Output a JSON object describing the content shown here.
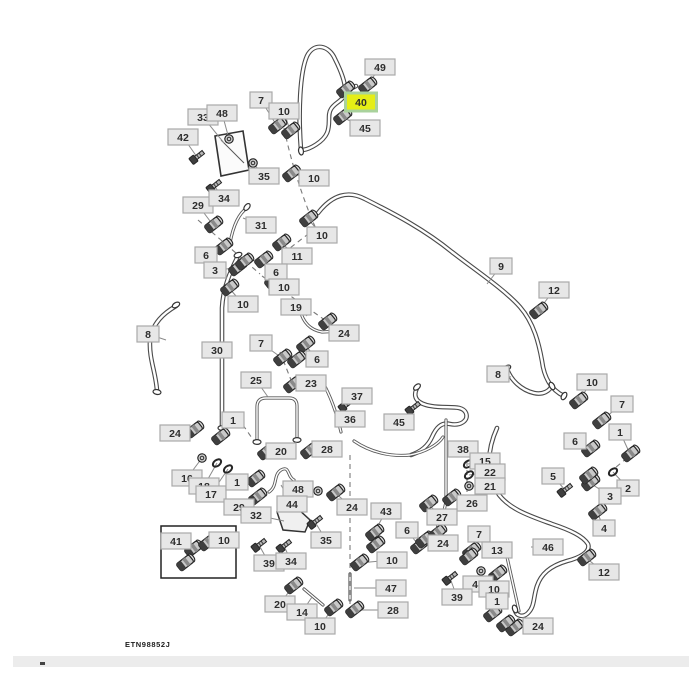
{
  "figure_code": "ETN98852J",
  "diagram": {
    "canvas": {
      "w": 700,
      "h": 700,
      "bg": "#ffffff"
    },
    "styles": {
      "label_fill": "#e7e7e7",
      "label_border": "#a9a9a9",
      "label_text": "#2e2e2e",
      "highlight_fill": "#e5ee16",
      "highlight_border": "#a9d29c",
      "hose_outer": "#4a4a4a",
      "hose_inner": "#ffffff",
      "tube_outer": "#5a5a5a",
      "tube_inner": "#ffffff",
      "dash_color": "#7a7a7a",
      "leader_color": "#8a8a8a",
      "part_dark": "#3f3f3f",
      "part_mid": "#8a8a8a",
      "part_light": "#c9c9c9",
      "part_stroke": "#262626"
    },
    "callouts": [
      {
        "n": "49",
        "x": 380,
        "y": 67,
        "tx": 367,
        "ty": 86,
        "k": "f"
      },
      {
        "n": "40",
        "x": 361,
        "y": 102,
        "tx": 345,
        "ty": 90,
        "k": "f",
        "hl": true
      },
      {
        "n": "45",
        "x": 365,
        "y": 128,
        "tx": 342,
        "ty": 117,
        "k": "f"
      },
      {
        "n": "7",
        "x": 261,
        "y": 100,
        "tx": 277,
        "ty": 126,
        "k": "f"
      },
      {
        "n": "10",
        "x": 284,
        "y": 111,
        "tx": 290,
        "ty": 131,
        "k": "f"
      },
      {
        "n": "33",
        "x": 203,
        "y": 117,
        "tx": 224,
        "ty": 143,
        "k": "none"
      },
      {
        "n": "48",
        "x": 222,
        "y": 113,
        "tx": 229,
        "ty": 139,
        "k": "n"
      },
      {
        "n": "42",
        "x": 183,
        "y": 137,
        "tx": 197,
        "ty": 157,
        "k": "b"
      },
      {
        "n": "35",
        "x": 264,
        "y": 176,
        "tx": 253,
        "ty": 163,
        "k": "n"
      },
      {
        "n": "10",
        "x": 314,
        "y": 178,
        "tx": 291,
        "ty": 174,
        "k": "f"
      },
      {
        "n": "29",
        "x": 198,
        "y": 205,
        "tx": 213,
        "ty": 225,
        "k": "f"
      },
      {
        "n": "34",
        "x": 224,
        "y": 198,
        "tx": 214,
        "ty": 186,
        "k": "b"
      },
      {
        "n": "31",
        "x": 261,
        "y": 225,
        "tx": 243,
        "ty": 218,
        "k": "none"
      },
      {
        "n": "10",
        "x": 322,
        "y": 235,
        "tx": 308,
        "ty": 219,
        "k": "f"
      },
      {
        "n": "11",
        "x": 297,
        "y": 256,
        "tx": 281,
        "ty": 243,
        "k": "f"
      },
      {
        "n": "6",
        "x": 206,
        "y": 255,
        "tx": 223,
        "ty": 247,
        "k": "f"
      },
      {
        "n": "3",
        "x": 215,
        "y": 270,
        "tx": 237,
        "ty": 268,
        "k": "f"
      },
      {
        "n": "6",
        "x": 276,
        "y": 272,
        "tx": 263,
        "ty": 260,
        "k": "f"
      },
      {
        "n": "10",
        "x": 284,
        "y": 287,
        "tx": 273,
        "ty": 281,
        "k": "f"
      },
      {
        "n": "10",
        "x": 243,
        "y": 304,
        "tx": 229,
        "ty": 288,
        "k": "f"
      },
      {
        "n": "19",
        "x": 296,
        "y": 307,
        "tx": 307,
        "ty": 316,
        "k": "none"
      },
      {
        "n": "24",
        "x": 344,
        "y": 333,
        "tx": 327,
        "ty": 322,
        "k": "f"
      },
      {
        "n": "8",
        "x": 148,
        "y": 334,
        "tx": 166,
        "ty": 340,
        "k": "none"
      },
      {
        "n": "30",
        "x": 217,
        "y": 350,
        "tx": 227,
        "ty": 347,
        "k": "none"
      },
      {
        "n": "7",
        "x": 261,
        "y": 343,
        "tx": 282,
        "ty": 358,
        "k": "f"
      },
      {
        "n": "6",
        "x": 317,
        "y": 359,
        "tx": 305,
        "ty": 345,
        "k": "f"
      },
      {
        "n": "25",
        "x": 256,
        "y": 380,
        "tx": 268,
        "ty": 397,
        "k": "none"
      },
      {
        "n": "23",
        "x": 311,
        "y": 383,
        "tx": 292,
        "ty": 385,
        "k": "f"
      },
      {
        "n": "37",
        "x": 357,
        "y": 396,
        "tx": 346,
        "ty": 405,
        "k": "b"
      },
      {
        "n": "36",
        "x": 350,
        "y": 419,
        "tx": 340,
        "ty": 421,
        "k": "none"
      },
      {
        "n": "45",
        "x": 399,
        "y": 422,
        "tx": 413,
        "ty": 408,
        "k": "b"
      },
      {
        "n": "9",
        "x": 501,
        "y": 266,
        "tx": 487,
        "ty": 284,
        "k": "none"
      },
      {
        "n": "12",
        "x": 554,
        "y": 290,
        "tx": 538,
        "ty": 311,
        "k": "f"
      },
      {
        "n": "8",
        "x": 498,
        "y": 374,
        "tx": 511,
        "ty": 377,
        "k": "none"
      },
      {
        "n": "10",
        "x": 592,
        "y": 382,
        "tx": 578,
        "ty": 401,
        "k": "f"
      },
      {
        "n": "7",
        "x": 622,
        "y": 404,
        "tx": 601,
        "ty": 421,
        "k": "f"
      },
      {
        "n": "1",
        "x": 620,
        "y": 432,
        "tx": 630,
        "ty": 454,
        "k": "f"
      },
      {
        "n": "6",
        "x": 575,
        "y": 441,
        "tx": 590,
        "ty": 449,
        "k": "f"
      },
      {
        "n": "5",
        "x": 553,
        "y": 476,
        "tx": 565,
        "ty": 490,
        "k": "b"
      },
      {
        "n": "2",
        "x": 628,
        "y": 488,
        "tx": 613,
        "ty": 472,
        "k": "r"
      },
      {
        "n": "3",
        "x": 610,
        "y": 496,
        "tx": 590,
        "ty": 483,
        "k": "f"
      },
      {
        "n": "4",
        "x": 604,
        "y": 528,
        "tx": 597,
        "ty": 512,
        "k": "f"
      },
      {
        "n": "12",
        "x": 604,
        "y": 572,
        "tx": 586,
        "ty": 558,
        "k": "f"
      },
      {
        "n": "46",
        "x": 548,
        "y": 547,
        "tx": 531,
        "ty": 547,
        "k": "none"
      },
      {
        "n": "38",
        "x": 463,
        "y": 449,
        "tx": 448,
        "ty": 450,
        "k": "none"
      },
      {
        "n": "15",
        "x": 485,
        "y": 461,
        "tx": 468,
        "ty": 464,
        "k": "r"
      },
      {
        "n": "22",
        "x": 490,
        "y": 472,
        "tx": 469,
        "ty": 475,
        "k": "r"
      },
      {
        "n": "21",
        "x": 490,
        "y": 486,
        "tx": 469,
        "ty": 486,
        "k": "n"
      },
      {
        "n": "26",
        "x": 472,
        "y": 503,
        "tx": 451,
        "ty": 498,
        "k": "f"
      },
      {
        "n": "27",
        "x": 442,
        "y": 517,
        "tx": 428,
        "ty": 504,
        "k": "f"
      },
      {
        "n": "24",
        "x": 352,
        "y": 507,
        "tx": 335,
        "ty": 493,
        "k": "f"
      },
      {
        "n": "43",
        "x": 386,
        "y": 511,
        "tx": 374,
        "ty": 533,
        "k": "f"
      },
      {
        "n": "6",
        "x": 407,
        "y": 530,
        "tx": 419,
        "ty": 546,
        "k": "f"
      },
      {
        "n": "24",
        "x": 443,
        "y": 543,
        "tx": 424,
        "ty": 540,
        "k": "f"
      },
      {
        "n": "10",
        "x": 392,
        "y": 560,
        "tx": 359,
        "ty": 563,
        "k": "f"
      },
      {
        "n": "47",
        "x": 391,
        "y": 588,
        "tx": 354,
        "ty": 588,
        "k": "none"
      },
      {
        "n": "28",
        "x": 393,
        "y": 610,
        "tx": 354,
        "ty": 610,
        "k": "f"
      },
      {
        "n": "7",
        "x": 479,
        "y": 534,
        "tx": 471,
        "ty": 551,
        "k": "f"
      },
      {
        "n": "13",
        "x": 497,
        "y": 550,
        "tx": 507,
        "ty": 553,
        "k": "none"
      },
      {
        "n": "48",
        "x": 478,
        "y": 584,
        "tx": 481,
        "ty": 571,
        "k": "n"
      },
      {
        "n": "10",
        "x": 494,
        "y": 589,
        "tx": 497,
        "ty": 574,
        "k": "f"
      },
      {
        "n": "39",
        "x": 457,
        "y": 597,
        "tx": 450,
        "ty": 578,
        "k": "b"
      },
      {
        "n": "1",
        "x": 497,
        "y": 601,
        "tx": 492,
        "ty": 614,
        "k": "f"
      },
      {
        "n": "24",
        "x": 538,
        "y": 626,
        "tx": 514,
        "ty": 628,
        "k": "f"
      },
      {
        "n": "20",
        "x": 281,
        "y": 451,
        "tx": 266,
        "ty": 452,
        "k": "f"
      },
      {
        "n": "28",
        "x": 327,
        "y": 449,
        "tx": 309,
        "ty": 451,
        "k": "f"
      },
      {
        "n": "1",
        "x": 233,
        "y": 420,
        "tx": 220,
        "ty": 437,
        "k": "f"
      },
      {
        "n": "24",
        "x": 175,
        "y": 433,
        "tx": 194,
        "ty": 430,
        "k": "f"
      },
      {
        "n": "16",
        "x": 187,
        "y": 478,
        "tx": 202,
        "ty": 458,
        "k": "n"
      },
      {
        "n": "18",
        "x": 204,
        "y": 486,
        "tx": 217,
        "ty": 463,
        "k": "r"
      },
      {
        "n": "17",
        "x": 211,
        "y": 494,
        "tx": 228,
        "ty": 469,
        "k": "r"
      },
      {
        "n": "1",
        "x": 237,
        "y": 482,
        "tx": 255,
        "ty": 479,
        "k": "f"
      },
      {
        "n": "29",
        "x": 239,
        "y": 507,
        "tx": 257,
        "ty": 497,
        "k": "f"
      },
      {
        "n": "32",
        "x": 256,
        "y": 515,
        "tx": 284,
        "ty": 521,
        "k": "none"
      },
      {
        "n": "48",
        "x": 298,
        "y": 489,
        "tx": 318,
        "ty": 491,
        "k": "n"
      },
      {
        "n": "44",
        "x": 292,
        "y": 504,
        "tx": 281,
        "ty": 485,
        "k": "none"
      },
      {
        "n": "35",
        "x": 326,
        "y": 540,
        "tx": 315,
        "ty": 522,
        "k": "b"
      },
      {
        "n": "41",
        "x": 176,
        "y": 541,
        "tx": 193,
        "ty": 549,
        "k": "f"
      },
      {
        "n": "10",
        "x": 224,
        "y": 540,
        "tx": 207,
        "ty": 543,
        "k": "f"
      },
      {
        "n": "39",
        "x": 269,
        "y": 563,
        "tx": 259,
        "ty": 545,
        "k": "b"
      },
      {
        "n": "34",
        "x": 291,
        "y": 561,
        "tx": 284,
        "ty": 546,
        "k": "b"
      },
      {
        "n": "20",
        "x": 280,
        "y": 604,
        "tx": 293,
        "ty": 586,
        "k": "f"
      },
      {
        "n": "14",
        "x": 302,
        "y": 612,
        "tx": 312,
        "ty": 597,
        "k": "none"
      },
      {
        "n": "10",
        "x": 320,
        "y": 626,
        "tx": 333,
        "ty": 608,
        "k": "f"
      }
    ],
    "hoses": [
      "M301,150 C298,112 300,72 307,56 C314,42 329,45 335,59 C341,71 346,84 345,92 C344,101 335,102 331,109 C327,115 331,124 327,133 C323,142 310,149 303,150",
      "M345,92 C349,89 352,88 356,86",
      "M318,213 C332,195 348,190 365,199 C395,214 425,230 452,252 C478,272 505,290 520,307 C534,323 539,344 542,361 C544,377 551,390 564,396",
      "M176,306 C164,313 152,323 150,341 C149,359 156,373 157,391",
      "M238,256 C230,272 223,288 222,308 L222,428",
      "M417,388 C412,398 418,404 431,406 C447,409 462,404 466,413 C469,421 460,426 450,424 C441,422 436,428 432,437 C428,446 420,452 411,455",
      "M497,428 C487,450 486,474 497,492 C508,509 530,516 552,524 C570,530 583,536 588,544 C591,552 579,558 567,561 C550,566 541,574 537,586 C533,598 535,606 528,613 C523,618 516,616 515,610",
      "M507,369 C511,380 521,390 534,393 C543,395 550,391 552,385"
    ],
    "tubes": [
      "M257,442 L257,407 Q257,398 266,398 L289,398 Q297,398 297,406 L297,440",
      "M230,243 C233,227 238,214 247,208",
      "M300,310 C303,322 310,330 322,332 L343,331",
      "M354,441 C370,452 390,457 410,455 C425,452 438,445 443,437",
      "M446,420 L446,498 C446,510 441,516 438,524 L437,533",
      "M505,548 L519,611",
      "M350,574 L350,600",
      "M304,589 L323,605",
      "M269,492 C278,486 273,475 281,470 C290,465 287,477 294,480",
      "M322,381 C330,395 336,410 341,432"
    ],
    "dashes": [
      "M284,128 C291,162 303,200 317,231",
      "M316,228 L290,248",
      "M198,220 L260,274",
      "M262,276 L342,332",
      "M280,352 L291,380",
      "M350,455 L350,614",
      "M467,452 L467,492",
      "M627,458 L615,468",
      "M243,425 L256,444"
    ],
    "caps": [
      {
        "x": 301,
        "y": 151,
        "a": 80
      },
      {
        "x": 176,
        "y": 305,
        "a": -30
      },
      {
        "x": 157,
        "y": 392,
        "a": 10
      },
      {
        "x": 238,
        "y": 255,
        "a": -20
      },
      {
        "x": 222,
        "y": 428,
        "a": 0
      },
      {
        "x": 417,
        "y": 387,
        "a": -40
      },
      {
        "x": 515,
        "y": 609,
        "a": 70
      },
      {
        "x": 507,
        "y": 368,
        "a": -30
      },
      {
        "x": 552,
        "y": 386,
        "a": 60
      },
      {
        "x": 257,
        "y": 442,
        "a": 0
      },
      {
        "x": 297,
        "y": 440,
        "a": 0
      },
      {
        "x": 247,
        "y": 207,
        "a": -50
      },
      {
        "x": 343,
        "y": 331,
        "a": 90
      },
      {
        "x": 564,
        "y": 396,
        "a": -60
      }
    ],
    "extra_parts": [
      {
        "x": 185,
        "y": 563,
        "k": "f"
      },
      {
        "x": 244,
        "y": 262,
        "k": "f"
      },
      {
        "x": 375,
        "y": 545,
        "k": "f"
      },
      {
        "x": 468,
        "y": 557,
        "k": "f"
      },
      {
        "x": 588,
        "y": 476,
        "k": "f"
      },
      {
        "x": 505,
        "y": 624,
        "k": "f"
      },
      {
        "x": 437,
        "y": 533,
        "k": "f"
      },
      {
        "x": 296,
        "y": 360,
        "k": "f"
      }
    ],
    "plate": {
      "points": "215,136 243,131 249,170 221,176",
      "inner": "M221,140 L244,163"
    },
    "bracket": {
      "path": "M277,512 L297,508 L310,520 L305,532 L283,530 Z"
    },
    "inset_box": {
      "x": 161,
      "y": 526,
      "w": 75,
      "h": 52
    },
    "figure_label_pos": {
      "x": 125,
      "y": 647
    }
  },
  "scrollbar": {
    "tick": "thumb"
  }
}
